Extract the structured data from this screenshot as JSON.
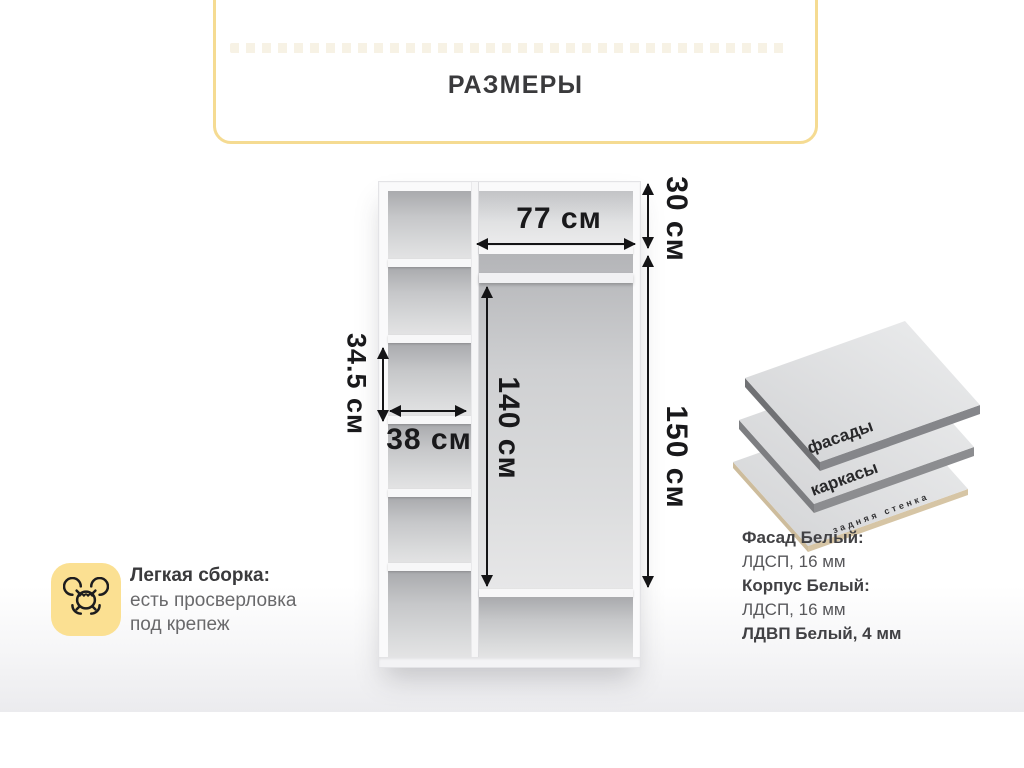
{
  "title": {
    "text": "РАЗМЕРЫ"
  },
  "diagram": {
    "dim_width_right": "77 см",
    "dim_height_top": "30 см",
    "dim_height_right": "150 см",
    "dim_height_inner": "140 см",
    "dim_shelf_height": "34.5 см",
    "dim_width_left": "38 см"
  },
  "assembly": {
    "icon": "wrench-hand-icon",
    "title": "Легкая сборка:",
    "line1": "есть просверловка",
    "line2": "под крепеж"
  },
  "materials": {
    "layer_front": "фасады",
    "layer_frame": "каркасы",
    "layer_back": "задняя стенка",
    "spec1_label": "Фасад Белый:",
    "spec1_value": "ЛДСП, 16 мм",
    "spec2_label": "Корпус Белый:",
    "spec2_value": "ЛДСП, 16 мм",
    "spec3_label": "ЛДВП Белый, 4 мм"
  },
  "colors": {
    "accent_yellow": "#f5db92",
    "icon_yellow": "#fbe092",
    "text_dark": "#3a3a3c",
    "text_gray": "#69696b",
    "dim_black": "#19191b"
  }
}
